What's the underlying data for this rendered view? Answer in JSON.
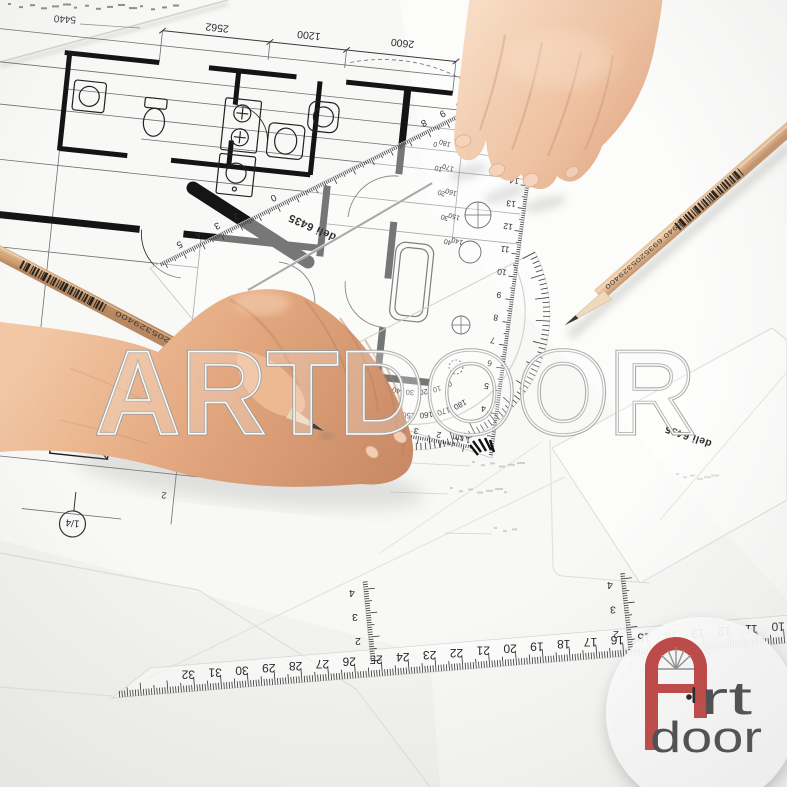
{
  "watermark": "ARTDOOR",
  "logo": {
    "rt": "rt",
    "door": "door"
  },
  "brand": {
    "protractor": "deli 6435",
    "triangle": "deli 6435"
  },
  "pencil": {
    "label": "5940 6935205329400"
  },
  "blueprint": {
    "dims": [
      "2562",
      "1200",
      "2600"
    ],
    "corner_dim": "5440",
    "scale_note": "1/4",
    "room_numbers": [
      "2",
      "1"
    ],
    "edge_numbers": [
      "20",
      "19"
    ]
  },
  "scales": {
    "bottom_ruler": [
      "32",
      "31",
      "30",
      "29",
      "28",
      "27",
      "26",
      "25",
      "24",
      "23",
      "22",
      "21",
      "20",
      "19",
      "18",
      "17",
      "16",
      "15",
      "14",
      "13",
      "12",
      "11",
      "10"
    ],
    "mini_v1": [
      "2",
      "3",
      "4"
    ],
    "mini_v2": [
      "2",
      "3",
      "4"
    ],
    "protractor_hyp": [
      {
        "u": -5,
        "t": "5"
      },
      {
        "u": -4,
        "t": "4"
      },
      {
        "u": -3,
        "t": "3"
      },
      {
        "u": -2,
        "t": "2"
      },
      {
        "u": 0,
        "t": "0"
      },
      {
        "u": 8,
        "t": "8"
      },
      {
        "u": 9,
        "t": "9"
      },
      {
        "u": 10,
        "t": "10"
      }
    ],
    "protractor_right": [
      "14",
      "13",
      "12",
      "11",
      "10",
      "9",
      "8",
      "7",
      "6",
      "5",
      "4"
    ],
    "protractor_bottom": [
      "1 cm",
      "2",
      "3",
      "4",
      "5",
      "6",
      "7"
    ],
    "degrees_outer": [
      "180",
      "170",
      "160",
      "150",
      "140",
      "130",
      "120",
      "110",
      "100",
      "90"
    ],
    "degrees_inner": [
      "0",
      "10",
      "20",
      "30",
      "40",
      "50",
      "60",
      "70",
      "80",
      "90"
    ],
    "degrees_flat_pairs": [
      [
        "0",
        "180"
      ],
      [
        "10",
        "170"
      ],
      [
        "20",
        "160"
      ],
      [
        "30",
        "150"
      ],
      [
        "40",
        "140"
      ]
    ]
  }
}
